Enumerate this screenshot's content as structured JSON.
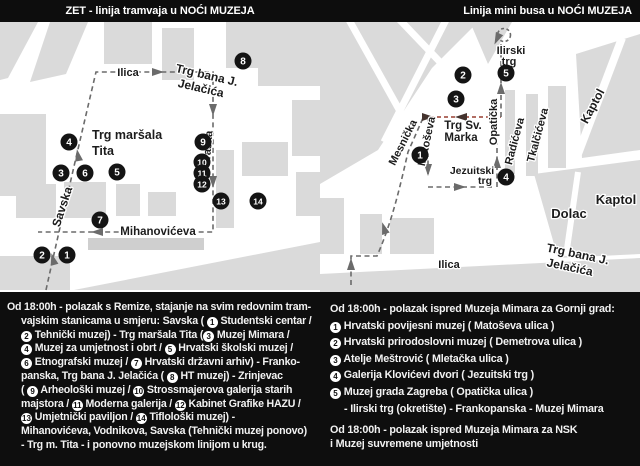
{
  "header_left": {
    "text": "ZET - linija tramvaja u",
    "highlight": "NOĆI MUZEJA"
  },
  "header_right": {
    "text": "Linija mini busa u",
    "highlight": "NOĆI MUZEJA"
  },
  "colors": {
    "route_gray": "#6b6b6b",
    "route_red": "#a85a4e",
    "block": "#dadada",
    "stop_circle": "#141414",
    "dark_bg": "#0e0e0e",
    "text_light": "#f2f2f2"
  },
  "map_left": {
    "title": "tram-line-map",
    "stops": [
      {
        "n": "1",
        "x": 67,
        "y": 233
      },
      {
        "n": "2",
        "x": 42,
        "y": 233
      },
      {
        "n": "3",
        "x": 61,
        "y": 151
      },
      {
        "n": "4",
        "x": 69,
        "y": 120
      },
      {
        "n": "5",
        "x": 117,
        "y": 150
      },
      {
        "n": "6",
        "x": 85,
        "y": 151
      },
      {
        "n": "7",
        "x": 100,
        "y": 198
      },
      {
        "n": "8",
        "x": 243,
        "y": 39
      },
      {
        "n": "9",
        "x": 203,
        "y": 120
      },
      {
        "n": "10",
        "x": 202,
        "y": 140
      },
      {
        "n": "11",
        "x": 202,
        "y": 151
      },
      {
        "n": "12",
        "x": 202,
        "y": 162
      },
      {
        "n": "13",
        "x": 221,
        "y": 179
      },
      {
        "n": "14",
        "x": 258,
        "y": 179
      }
    ],
    "labels": [
      {
        "text": "Ilica",
        "x": 128,
        "y": 54,
        "rot": 0,
        "size": 11,
        "halo": true
      },
      {
        "text": "Trg bana J.",
        "x": 206,
        "y": 57,
        "rot": 13,
        "size": 12,
        "halo": true
      },
      {
        "text": "Jelačića",
        "x": 200,
        "y": 70,
        "rot": 13,
        "size": 12,
        "halo": true
      },
      {
        "text": "Trg maršala",
        "x": 92,
        "y": 117,
        "rot": 0,
        "size": 12.5,
        "anchor": "start"
      },
      {
        "text": "Tita",
        "x": 92,
        "y": 133,
        "rot": 0,
        "size": 12.5,
        "anchor": "start"
      },
      {
        "text": "Savska",
        "x": 66,
        "y": 186,
        "rot": -72,
        "size": 12,
        "halo": true
      },
      {
        "text": "Praška",
        "x": 211,
        "y": 127,
        "rot": -85,
        "size": 11,
        "halo": true
      },
      {
        "text": "Mihanovićeva",
        "x": 158,
        "y": 213,
        "rot": 0,
        "size": 11.5,
        "halo": true
      }
    ]
  },
  "map_right": {
    "title": "mini-bus-line-map",
    "stops": [
      {
        "n": "1",
        "x": 100,
        "y": 133
      },
      {
        "n": "2",
        "x": 143,
        "y": 53
      },
      {
        "n": "3",
        "x": 136,
        "y": 77
      },
      {
        "n": "4",
        "x": 186,
        "y": 155
      },
      {
        "n": "5",
        "x": 186,
        "y": 51
      }
    ],
    "labels": [
      {
        "text": "Ilirski",
        "x": 191,
        "y": 32,
        "rot": 0,
        "size": 11,
        "halo": true
      },
      {
        "text": "trg",
        "x": 189,
        "y": 43,
        "rot": 0,
        "size": 11,
        "halo": true
      },
      {
        "text": "Trg Sv.",
        "x": 143,
        "y": 107,
        "rot": 0,
        "size": 11.5,
        "halo": true
      },
      {
        "text": "Marka",
        "x": 141,
        "y": 119,
        "rot": 0,
        "size": 11.5,
        "halo": true
      },
      {
        "text": "Jezuitski",
        "x": 152,
        "y": 152,
        "rot": 0,
        "size": 10.5,
        "halo": true
      },
      {
        "text": "trg",
        "x": 165,
        "y": 162,
        "rot": 0,
        "size": 10.5,
        "halo": true
      },
      {
        "text": "Mesnička",
        "x": 86,
        "y": 122,
        "rot": -63,
        "size": 11,
        "halo": true
      },
      {
        "text": "Matoševa",
        "x": 110,
        "y": 120,
        "rot": -78,
        "size": 11,
        "halo": true
      },
      {
        "text": "Opatička",
        "x": 177,
        "y": 100,
        "rot": -90,
        "size": 11,
        "halo": true
      },
      {
        "text": "Radićeva",
        "x": 198,
        "y": 120,
        "rot": -75,
        "size": 11,
        "halo": true
      },
      {
        "text": "Tkalčićeva",
        "x": 221,
        "y": 114,
        "rot": -75,
        "size": 11,
        "halo": true
      },
      {
        "text": "Kaptol",
        "x": 276,
        "y": 86,
        "rot": -62,
        "size": 12,
        "halo": true
      },
      {
        "text": "Kaptol",
        "x": 296,
        "y": 182,
        "rot": 0,
        "size": 13,
        "halo": true
      },
      {
        "text": "Dolac",
        "x": 249,
        "y": 196,
        "rot": 0,
        "size": 13,
        "halo": true
      },
      {
        "text": "Trg bana J.",
        "x": 257,
        "y": 236,
        "rot": 12,
        "size": 12,
        "halo": true
      },
      {
        "text": "Jelačića",
        "x": 249,
        "y": 249,
        "rot": 12,
        "size": 12,
        "halo": true
      },
      {
        "text": "Ilica",
        "x": 129,
        "y": 246,
        "rot": 0,
        "size": 11,
        "halo": true
      }
    ]
  },
  "schedule_left": {
    "lines": [
      [
        {
          "t": "Od 18:00h - polazak s Remize, stajanje na svim redovnim tram-"
        }
      ],
      [
        {
          "t": "vajskim stanicama u smjeru: Savska ( "
        },
        {
          "n": "1"
        },
        {
          "t": " Studentski centar /"
        }
      ],
      [
        {
          "n": "2"
        },
        {
          "t": " Tehnički muzej) - Trg maršala Tita ("
        },
        {
          "n": "3"
        },
        {
          "t": " Muzej Mimara /"
        }
      ],
      [
        {
          "n": "4"
        },
        {
          "t": " Muzej za umjetnost i obrt / "
        },
        {
          "n": "5"
        },
        {
          "t": " Hrvatski školski muzej /"
        }
      ],
      [
        {
          "n": "6"
        },
        {
          "t": " Etnografski muzej / "
        },
        {
          "n": "7"
        },
        {
          "t": " Hrvatski državni arhiv) - Franko-"
        }
      ],
      [
        {
          "t": "panska, Trg bana J. Jelačića ( "
        },
        {
          "n": "8"
        },
        {
          "t": " HT muzej) - Zrinjevac"
        }
      ],
      [
        {
          "t": "( "
        },
        {
          "n": "9"
        },
        {
          "t": " Arheološki muzej / "
        },
        {
          "n": "10"
        },
        {
          "t": " Strossmajerova galerija starih"
        }
      ],
      [
        {
          "t": "majstora / "
        },
        {
          "n": "11"
        },
        {
          "t": " Moderna galerija / "
        },
        {
          "n": "12"
        },
        {
          "t": " Kabinet Grafike HAZU /"
        }
      ],
      [
        {
          "n": "13"
        },
        {
          "t": " Umjetnički paviljon / "
        },
        {
          "n": "14"
        },
        {
          "t": " Tiflološki muzej) -"
        }
      ],
      [
        {
          "t": "Mihanovićeva, Vodnikova, Savska (Tehnički muzej ponovo)"
        }
      ],
      [
        {
          "t": "- Trg m. Tita - i ponovno muzejskom linijom u krug."
        }
      ]
    ]
  },
  "schedule_right": {
    "intro": "Od 18:00h - polazak ispred Muzeja Mimara za Gornji grad:",
    "items": [
      {
        "n": "1",
        "text": "Hrvatski povijesni muzej ( Matoševa ulica )"
      },
      {
        "n": "2",
        "text": "Hrvatski prirodoslovni muzej ( Demetrova ulica )"
      },
      {
        "n": "3",
        "text": "Atelje Meštrović ( Mletačka ulica )"
      },
      {
        "n": "4",
        "text": "Galerija Klovićevi dvori ( Jezuitski trg )"
      },
      {
        "n": "5",
        "text": "Muzej grada Zagreba ( Opatička ulica )"
      }
    ],
    "note": "- Ilirski trg (okretište) - Frankopanska - Muzej Mimara",
    "outro": [
      "Od 18:00h - polazak ispred Muzeja Mimara za NSK",
      "i Muzej suvremene umjetnosti"
    ]
  }
}
